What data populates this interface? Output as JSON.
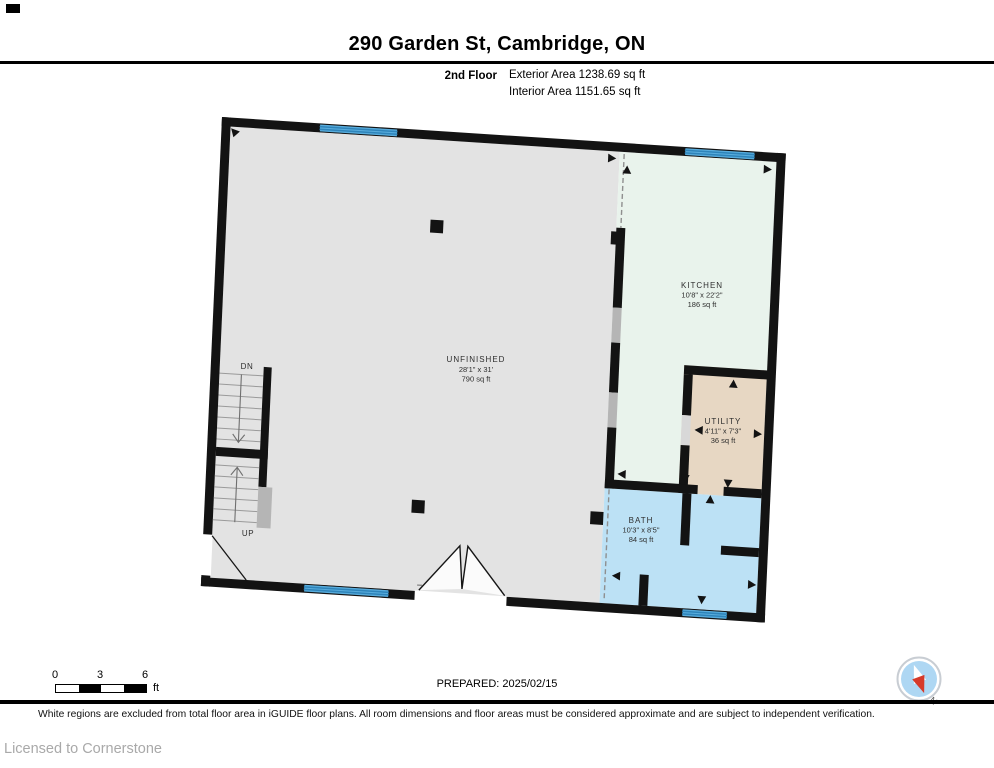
{
  "header": {
    "title": "290 Garden St, Cambridge, ON",
    "floor_label": "2nd Floor",
    "exterior_area": "Exterior Area 1238.69 sq ft",
    "interior_area": "Interior Area 1151.65 sq ft"
  },
  "rooms": {
    "unfinished": {
      "name": "UNFINISHED",
      "dims": "28'1\" x 31'",
      "area": "790 sq ft"
    },
    "kitchen": {
      "name": "KITCHEN",
      "dims": "10'8\" x 22'2\"",
      "area": "186 sq ft"
    },
    "utility": {
      "name": "UTILITY",
      "dims": "4'11\" x 7'3\"",
      "area": "36 sq ft"
    },
    "bath": {
      "name": "BATH",
      "dims": "10'3\" x 8'5\"",
      "area": "84 sq ft"
    }
  },
  "stairs": {
    "down_label": "DN",
    "up_label": "UP"
  },
  "scale_bar": {
    "labels": [
      "0",
      "3",
      "6"
    ],
    "unit": "ft"
  },
  "prepared_label": "PREPARED: 2025/02/15",
  "compass": {
    "north_label": "N"
  },
  "footer": {
    "disclaimer": "White regions are excluded from total floor area in iGUIDE floor plans. All room dimensions and floor areas must be considered approximate and are subject to independent verification.",
    "license": "Licensed to Cornerstone"
  },
  "colors": {
    "wall": "#131313",
    "unfinished": "#e3e3e3",
    "kitchen": "#e9f3ec",
    "utility": "#e7d7c3",
    "bath": "#bce1f5",
    "window_fill": "#58acdc",
    "window_stripe": "#2e84ba",
    "half_wall": "#b5b5b5",
    "compass_blue": "#aed7f3",
    "compass_red": "#d63a2a"
  }
}
